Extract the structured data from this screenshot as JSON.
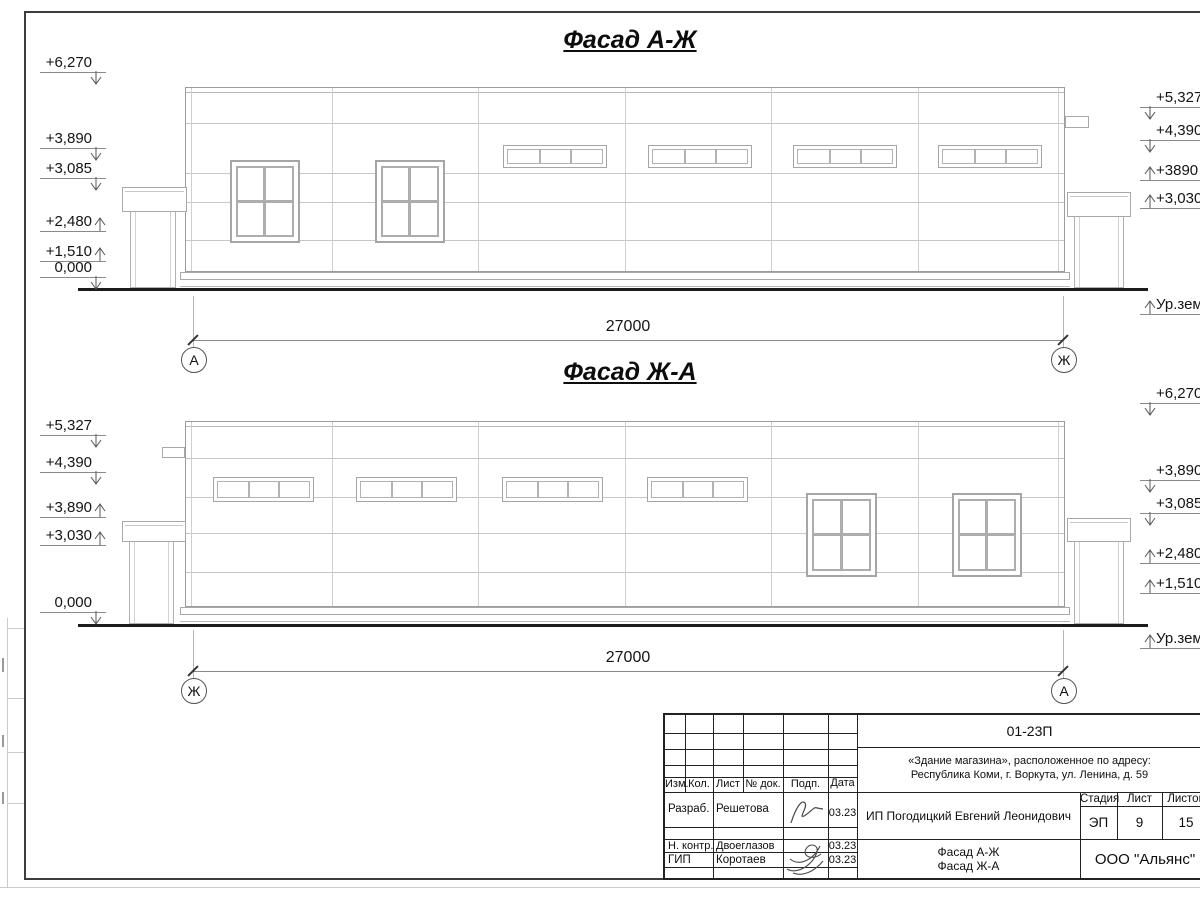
{
  "sheet": {
    "facades": [
      {
        "title": "Фасад А-Ж",
        "length_dim": "27000",
        "axis_left": "А",
        "axis_right": "Ж",
        "ground_label": "Ур.зем.",
        "marks_left": [
          {
            "label": "+6,270",
            "dir": "down"
          },
          {
            "label": "+3,890",
            "dir": "down"
          },
          {
            "label": "+3,085",
            "dir": "down"
          },
          {
            "label": "+2,480",
            "dir": "up"
          },
          {
            "label": "+1,510",
            "dir": "up"
          },
          {
            "label": "0,000",
            "dir": "down"
          }
        ],
        "marks_right": [
          {
            "label": "+5,327",
            "dir": "down"
          },
          {
            "label": "+4,390",
            "dir": "down"
          },
          {
            "label": "+3890",
            "dir": "up"
          },
          {
            "label": "+3,030",
            "dir": "up"
          }
        ]
      },
      {
        "title": "Фасад Ж-А",
        "length_dim": "27000",
        "axis_left": "Ж",
        "axis_right": "А",
        "ground_label": "Ур.зем.",
        "marks_left": [
          {
            "label": "+5,327",
            "dir": "down"
          },
          {
            "label": "+4,390",
            "dir": "down"
          },
          {
            "label": "+3,890",
            "dir": "up"
          },
          {
            "label": "+3,030",
            "dir": "up"
          },
          {
            "label": "0,000",
            "dir": "down"
          }
        ],
        "marks_right": [
          {
            "label": "+6,270",
            "dir": "down"
          },
          {
            "label": "+3,890",
            "dir": "down"
          },
          {
            "label": "+3,085",
            "dir": "down"
          },
          {
            "label": "+2,480",
            "dir": "up"
          },
          {
            "label": "+1,510",
            "dir": "up"
          }
        ]
      }
    ],
    "title_block": {
      "code": "01-23П",
      "address_line1": "«Здание магазина», расположенное по адресу:",
      "address_line2": "Республика Коми, г. Воркута, ул. Ленина, д. 59",
      "col_izm": "Изм.",
      "col_kol": "Кол.",
      "col_list": "Лист",
      "col_doc": "№ док.",
      "col_podp": "Подп.",
      "col_data": "Дата",
      "rows": [
        {
          "role": "Разраб.",
          "name": "Решетова",
          "date": "03.23"
        },
        {
          "role": "Н. контр.",
          "name": "Двоеглазов",
          "date": "03.23"
        },
        {
          "role": "ГИП",
          "name": "Коротаев",
          "date": "03.23"
        }
      ],
      "client": "ИП Погодицкий Евгений Леонидович",
      "stage_label": "Стадия",
      "list_label": "Лист",
      "listov_label": "Листов",
      "stage": "ЭП",
      "sheet_number": "9",
      "sheet_total": "15",
      "drawing_title_line1": "Фасад А-Ж",
      "drawing_title_line2": "Фасад Ж-А",
      "company": "ООО \"Альянс\""
    }
  }
}
